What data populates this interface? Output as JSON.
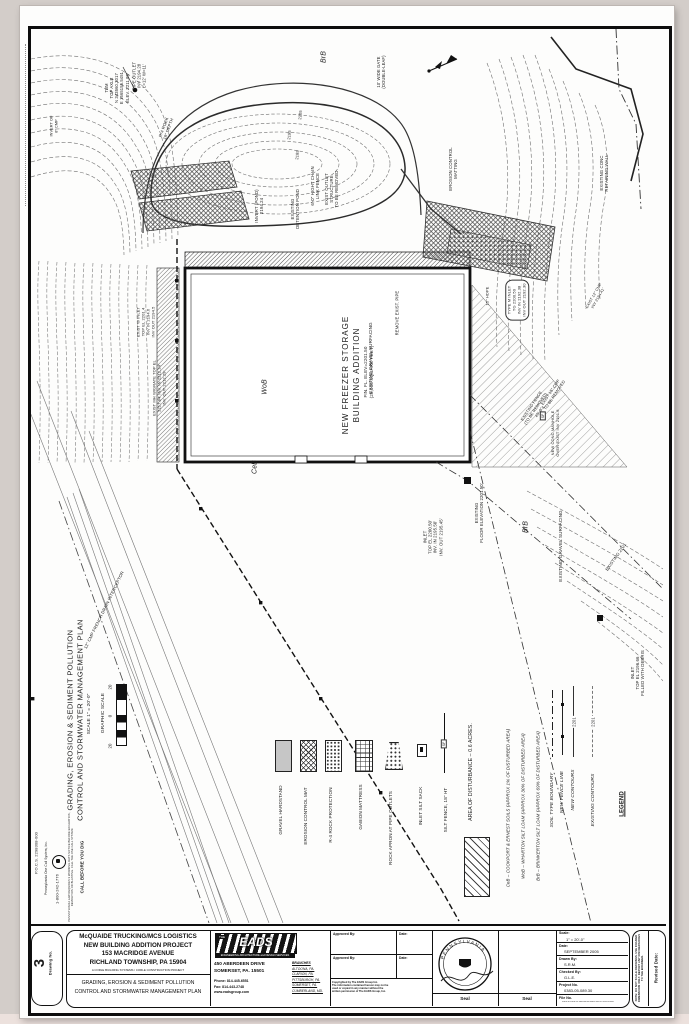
{
  "title_block": {
    "drawing_no_label": "Drawing No.",
    "drawing_no": "3",
    "project_line1": "McQUAIDE TRUCKING/MCS LOGISTICS",
    "project_line2": "NEW BUILDING ADDITION PROJECT",
    "project_line3": "153 MACRIDGE AVENUE",
    "project_line4": "RICHLAND TOWNSHIP, PA 15904",
    "project_line5": "A CORLE BUILDING SYSTEMS / CORLE CONSTRUCTION PROJECT",
    "sheet_title_line1": "GRADING, EROSION & SEDIMENT POLLUTION",
    "sheet_title_line2": "CONTROL AND STORMWATER MANAGEMENT PLAN",
    "firm": {
      "the": "THE",
      "name": "EADS",
      "tagline": "ENGINEERING ARCHITECTURE and DESIGN SERVICES",
      "address1": "450 ABERDEEN DRIVE",
      "address2": "SOMERSET, PA. 15501",
      "phone": "Phone: 814-445-6551",
      "fax": "Fax:    814-443-2748",
      "web": "www.eadsgroup.com",
      "branches_title": "BRANCHES",
      "branches": [
        "ALTOONA, PA.",
        "CLARION, PA.",
        "PITTSBURGH, PA.",
        "SOMERSET, PA.",
        "CUMBERLAND, MD."
      ]
    },
    "approved_by_label": "Approved By:",
    "date_label": "Date:",
    "copyright": "Copyrighted by The EADS Group Inc.\nThe information contained hereon may not be\nused or copied in any manner without the\nwritten permission of The EADS Group, Inc.",
    "seal_label": "Seal",
    "seal_state": "PENNSYLVANIA",
    "info": {
      "scale_label": "Scale:",
      "scale_value": "1\" = 20'-0\"",
      "date_label": "Date:",
      "date_value": "SEPTEMBER 2005",
      "drawn_label": "Drawn By:",
      "drawn_value": "S.R.M.",
      "checked_label": "Checked By:",
      "checked_value": "G.L.E.",
      "project_no_label": "Project No.",
      "project_no_value": "0383-05-089.30",
      "file_no_label": "File No.",
      "file_no_value": "0383-05-089.30 GRADING EROSION PLAN.DWG"
    },
    "side_note": "NOTE: DO NOT SCALE DRAWINGS. USE FIGURED DIMENSIONS ONLY. REPORT ANY DISCREPANCIES TO THE ENGINEER.",
    "revised_label": "Revised Date:"
  },
  "margin": {
    "plan_title_line1": "GRADING, EROSION & SEDIMENT POLLUTION",
    "plan_title_line2": "CONTROL AND STORMWATER MANAGEMENT PLAN",
    "graphic_scale_label": "GRAPHIC SCALE",
    "tick_top": "20",
    "tick_mid": "0",
    "tick_bottom": "20",
    "scale_note": "SCALE 1\" = 20'-0\"",
    "call_title": "CALL BEFORE YOU DIG",
    "call_body": "PENNSYLVANIA LAW REQUIRES 3 WORKING DAYS NOTICE BEFORE EXCAVATION, DEMOLITION OR BLASTING. CALL THE ONE CALL SYSTEM.",
    "call_org": "Pennsylvania One Call System, Inc.",
    "call_phone": "1-800-242-1776",
    "call_serial": "P.O.C.S. 2298308-000"
  },
  "legend": {
    "title": "LEGEND",
    "existing_contours_label": "EXISTING CONTOURS",
    "existing_contours_value": "2201",
    "new_contours_label": "NEW CONTOURS",
    "new_contours_value": "2201",
    "fence_line_label": "NEW FENCE LINE",
    "soil_boundary_label": "SOIL TYPE BOUNDARY",
    "soil_brb": "BrB – BRINKERTON SILT LOAM (APPROX 69% OF DISTURBED AREA)",
    "soil_wob": "WoB – WHARTON SILT LOAM (APPROX 30% OF DISTURBED AREA)",
    "soil_ceb": "CeB – COOKPORT & ERNEST SOILS (APPROX 1% OF DISTURBED AREA)",
    "area_of_disturbance": "AREA OF DISTURBANCE – 0.6 ACRES.",
    "sf_tag": "SF",
    "items": [
      {
        "label": "SILT FENCE, 18\" HT"
      },
      {
        "label": "INLET SILT SACK"
      },
      {
        "label": "ROCK APRON AT PIPE OUTLETS"
      },
      {
        "label": "GABION MATTRESS"
      },
      {
        "label": "R-4 ROCK PROTECTION"
      },
      {
        "label": "EROSION CONTROL MAT"
      },
      {
        "label": "GRAVEL HARDSTAND"
      }
    ]
  },
  "plan": {
    "building_line1": "NEW FREEZER STORAGE",
    "building_line2": "BUILDING ADDITION",
    "building_line3": "FIN. FL. ELEV=2201.50",
    "building_line4": "(25,000 SQUARE FEET)",
    "soil_brb_top": "BrB",
    "soil_wob": "WoB",
    "soil_ceb": "CeB",
    "soil_brb_right": "BrB",
    "callouts": {
      "tbm": "TBM\nTOP AXLE\nN 343560.3017\nE 1665155.5451\nELEV. 2211.86'",
      "pipe_outlet": "PIPE OUTLET\nINV 2194.28\nL=12'  W=11'",
      "r4_rock": "R-4 ROCK\n18\" DEPTH",
      "invert_cmp": "INVERT OF\n8\" CMP",
      "wide_gate": "10' WIDE GATE\n(DOUBLE-LEAF)",
      "detention_pond": "EXISTING\nDETENTION POND",
      "invert_pond": "INVERT (POND)\n2194.24",
      "chain_fence": "6'-0\" HIGHT CHAIN\nLINK FENCE",
      "outlet_removed": "EXIST OUTLET\nSTRUCTURE\nTO BE REMOVED",
      "erosion_matting": "EROSION CONTROL\nMATTING",
      "retaining_wall": "EXISTING CONC\nRETAINING WALL",
      "gravel_1": "EXISTING GRAVEL SURFACING",
      "remove_pipe": "REMOVE EXIST. PIPE",
      "w_inlet": "EXIST W INLET\nTOP EL 2201.4\nINV IN 2194.6\nINV OUT 2194.5",
      "mh_grate": "EXIST MH W/GRATE TOP EL\n2217.84'  INV. IN 2212.24'\nINV. OUT 2212.29'",
      "french_drain": "12\" CMP FRENCH DRAIN INTERCEPTOR",
      "type_m_inlet": "TYPE M INLET\nTG 2200.50\nINV IN 2192.38\nINV OUT 2192.30",
      "hdpe": "15\" HDPE",
      "cmp_removed": "EXIST 15\" CMP\nTO BE REMOVED",
      "fence_removed": "EXISTING FENCE\n(TO BE REMOVED)\n45'-0\"±",
      "new_manhole": "NEW CONC MANHOLE\nOVER EXIST INV 2191.6",
      "inlet_bottom": "INLET\nTOP EL 2200.50'\nINV. IN 2195.50'\nINV. OUT 2195.45'",
      "floor_elev": "EXISTING\nFLOOR ELEVATION 2201.50'",
      "gravel_2": "EXISTING GRAVEL SURFACING",
      "inlet_debris": "INLET\nTOP EL 2196.66\nFILLED WITH DEBRIS",
      "exist_cmp": "EXIST 12\" CMP\nINV 2194.41'",
      "c2205": "2205",
      "c2195": "2195",
      "c2185": "2185",
      "existing_2201": "EXISTING  2201",
      "sf": "SF"
    }
  }
}
